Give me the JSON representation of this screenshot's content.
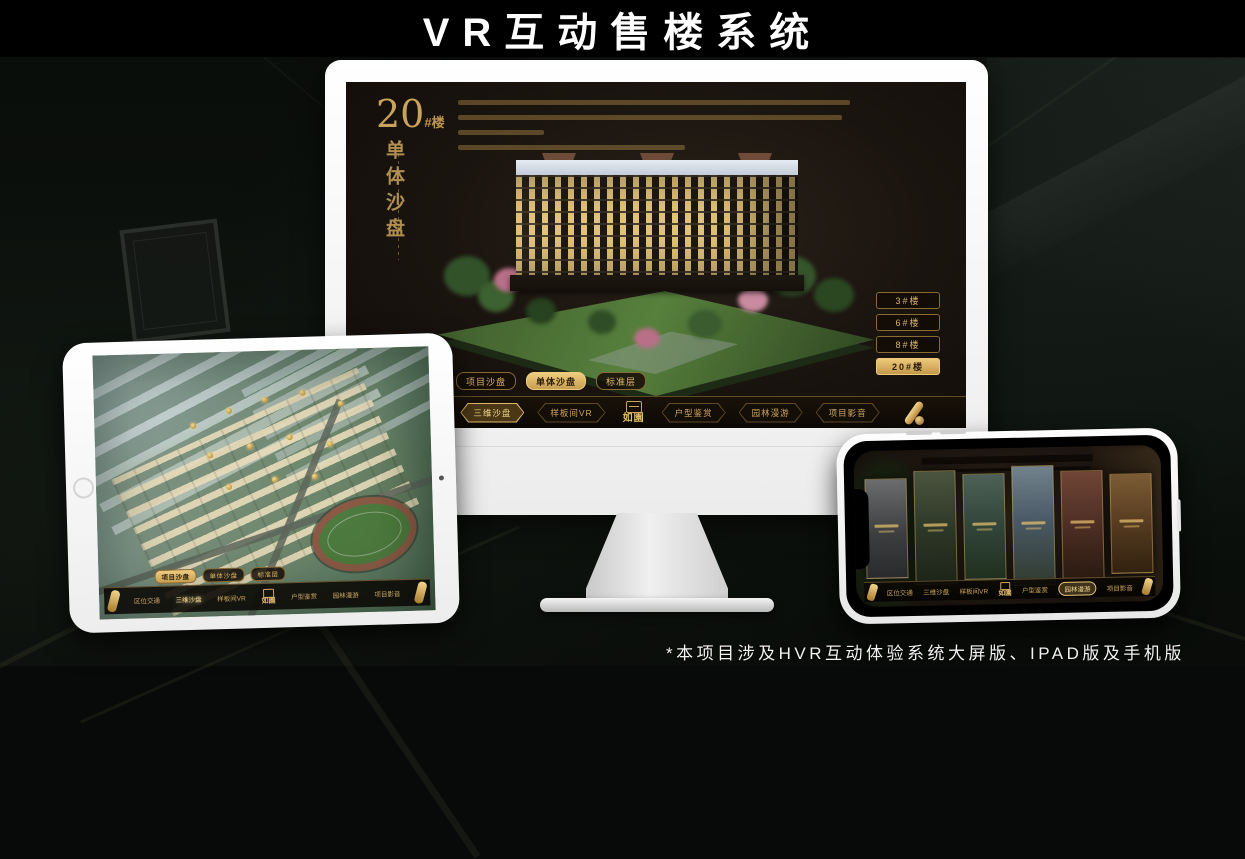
{
  "page": {
    "title": "VR互动售楼系统",
    "footnote": "*本项目涉及HVR互动体验系统大屏版、IPAD版及手机版"
  },
  "colors": {
    "gold_accent": "#c9a25a",
    "gold_active": "#ecca7a",
    "screen_background": "#1b1510",
    "page_background": "#0a0d0a"
  },
  "monitor_app": {
    "unit_number": "20",
    "unit_suffix": "#楼",
    "section_title": "单体沙盘",
    "floor_buttons": [
      "3#楼",
      "6#楼",
      "8#楼",
      "20#楼"
    ],
    "tabs": [
      "项目沙盘",
      "单体沙盘",
      "标准层"
    ],
    "nav_left": [
      "区位交通",
      "三维沙盘",
      "样板间VR"
    ],
    "nav_right": [
      "户型鉴赏",
      "园林漫游",
      "项目影音"
    ],
    "logo": "如園"
  },
  "tablet_app": {
    "tabs": [
      "项目沙盘",
      "单体沙盘",
      "标准层"
    ],
    "nav_left": [
      "区位交通",
      "三维沙盘",
      "样板间VR"
    ],
    "nav_right": [
      "户型鉴赏",
      "园林漫游",
      "项目影音"
    ],
    "logo": "如園"
  },
  "phone_app": {
    "nav_left": [
      "区位交通",
      "三维沙盘",
      "样板间VR"
    ],
    "nav_right": [
      "户型鉴赏",
      "园林漫游",
      "项目影音"
    ],
    "logo": "如園"
  }
}
